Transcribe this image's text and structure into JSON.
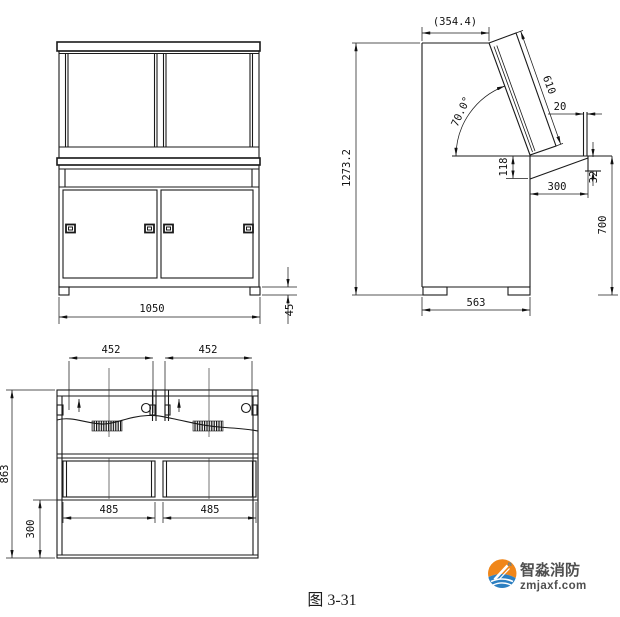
{
  "colors": {
    "line": "#1a1a1a",
    "logo_orange": "#f08619",
    "logo_blue": "#2d7fc0",
    "logo_text": "#4f4f4f"
  },
  "front_view": {
    "dims": {
      "width": "1050",
      "foot_height": "45"
    }
  },
  "side_view": {
    "dims": {
      "overall_height": "1273.2",
      "top_depth": "(354.4)",
      "panel_length": "610",
      "panel_angle": "70.0°",
      "lip_width": "20",
      "recess_drop": "118",
      "desk_overhang": "300",
      "edge_thickness": "32",
      "desk_height": "700",
      "cabinet_depth": "563"
    }
  },
  "plan_view": {
    "dims": {
      "span_left": "452",
      "span_right": "452",
      "overall_depth": "863",
      "front_depth": "300",
      "door_left": "485",
      "door_right": "485"
    }
  },
  "caption": "图 3-31",
  "logo": {
    "name": "智淼消防",
    "site": "zmjaxf.com"
  }
}
